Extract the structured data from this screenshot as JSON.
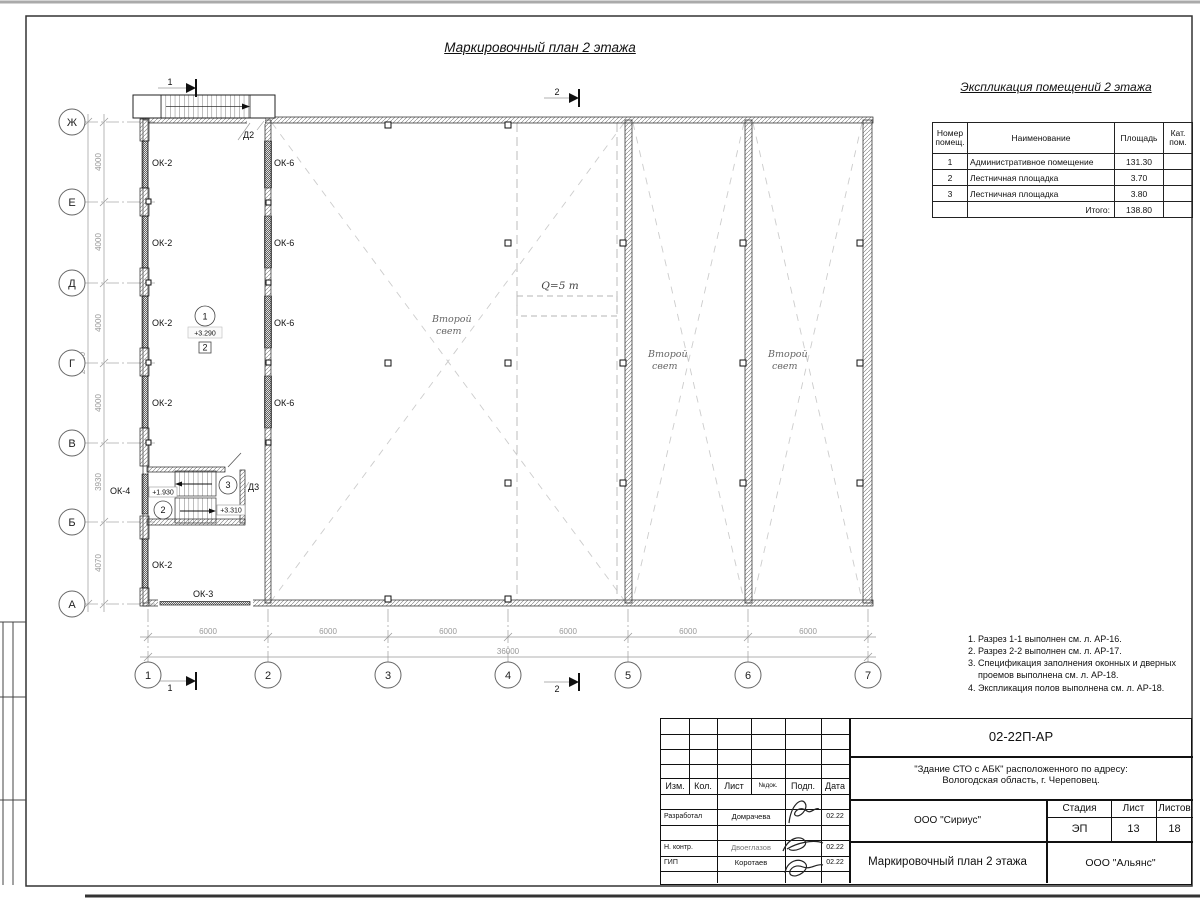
{
  "sheet": {
    "title": "Маркировочный план 2 этажа",
    "explication": {
      "title": "Экспликация помещений 2 этажа",
      "headers": {
        "num": "Номер\nпомещ.",
        "name": "Наименование",
        "area": "Площадь",
        "cat": "Кат.\nпом."
      },
      "rows": [
        {
          "num": "1",
          "name": "Административное помещение",
          "area": "131.30",
          "cat": ""
        },
        {
          "num": "2",
          "name": "Лестничная площадка",
          "area": "3.70",
          "cat": ""
        },
        {
          "num": "3",
          "name": "Лестничная площадка",
          "area": "3.80",
          "cat": ""
        }
      ],
      "total_label": "Итого:",
      "total": "138.80"
    },
    "notes": [
      "1. Разрез 1-1 выполнен см. л. АР-16.",
      "2. Разрез 2-2 выполнен см. л. АР-17.",
      "3. Спецификация заполнения оконных и дверных\n    проемов выполнена см. л. АР-18.",
      "4. Экспликация полов выполнена см. л. АР-18."
    ]
  },
  "plan": {
    "axes_rows": [
      "Ж",
      "Е",
      "Д",
      "Г",
      "В",
      "Б",
      "А"
    ],
    "axes_cols": [
      "1",
      "2",
      "3",
      "4",
      "5",
      "6",
      "7"
    ],
    "dims": {
      "d6000": "6000",
      "d36000": "36000",
      "d4000": "4000",
      "d3930": "3930",
      "d4070": "4070",
      "d24000": "24000"
    },
    "labels": {
      "ok2": "ОК-2",
      "ok3": "ОК-3",
      "ok4": "ОК-4",
      "ok6": "ОК-6",
      "d2": "Д2",
      "d3": "Д3",
      "second_light_1": "Второй",
      "second_light_2": "свет",
      "crane": "Q=5 т",
      "section1": "1",
      "section2": "2"
    },
    "rooms": {
      "r1": {
        "num": "1",
        "elev": "+3.290",
        "box": "2"
      },
      "r2": {
        "num": "2",
        "elev": "+1.930"
      },
      "r3": {
        "num": "3",
        "elev": "+3.310"
      }
    }
  },
  "titleblock": {
    "doc_number": "02-22П-АР",
    "project_line1": "\"Здание СТО с АБК\" расположенного по адресу:",
    "project_line2": "Вологодская область, г. Череповец.",
    "header_cells": [
      "Изм.",
      "Кол.",
      "Лист",
      "№док.",
      "Подп.",
      "Дата"
    ],
    "rows": [
      {
        "role": "Разработал",
        "name": "Домрачева",
        "date": "02.22"
      },
      {
        "role": "Н. контр.",
        "name": "Двоеглазов",
        "date": "02.22"
      },
      {
        "role": "ГИП",
        "name": "Коротаев",
        "date": "02.22"
      }
    ],
    "org": "ООО \"Сириус\"",
    "stage_label": "Стадия",
    "sheet_label": "Лист",
    "sheets_label": "Листов",
    "stage": "ЭП",
    "sheet_num": "13",
    "sheets_total": "18",
    "drawing_title": "Маркировочный план 2 этажа",
    "company": "ООО \"Альянс\""
  }
}
